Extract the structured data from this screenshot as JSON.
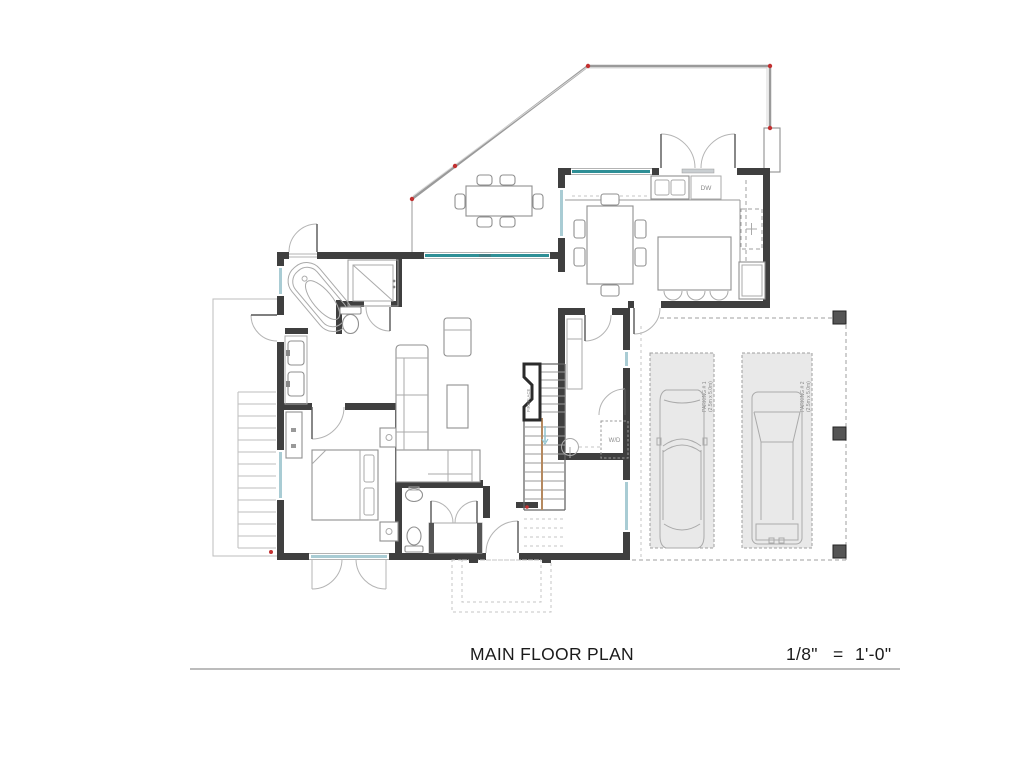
{
  "drawing": {
    "title": "MAIN FLOOR PLAN",
    "scale_fraction": "1/8\"",
    "scale_equals": "=",
    "scale_value": "1'-0\""
  },
  "labels": {
    "dishwasher": "DW",
    "washer_dryer": "W/D",
    "fireplace": "FIREPLACE",
    "parking1_name": "PARKING # 1",
    "parking1_size": "(2.5m x 5.0m)",
    "parking2_name": "PARKING # 2",
    "parking2_size": "(2.5m x 5.0m)"
  },
  "colors": {
    "wall": "#3f3f3f",
    "window_glass": "#a9ccd4",
    "slider_glass": "#2e8f96",
    "marker_red": "#c23030",
    "stall_fill": "#e9e9e9",
    "wood": "#b5895f"
  }
}
